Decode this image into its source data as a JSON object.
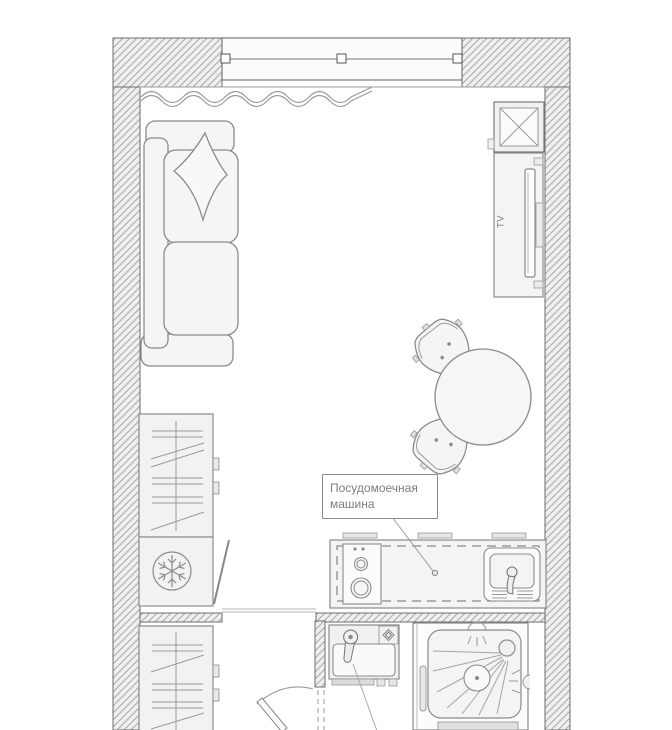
{
  "labels": {
    "tv": "TV",
    "dishwasher_line1": "Посудомоечная",
    "dishwasher_line2": "машина"
  },
  "colors": {
    "background": "#ffffff",
    "wall_fill": "#efefef",
    "wall_hatch": "#a8a8a8",
    "wall_edge": "#6e6e6e",
    "line": "#8b8b8b",
    "line_light": "#aaaaaa",
    "furniture_fill": "#f4f4f4",
    "text": "#7d7d7d"
  },
  "icons": {
    "freezer": "snowflake-icon",
    "ventilation": "x-cross-icon",
    "wardrobe": "hanger-rail-icon",
    "shower": "shower-spray-icon",
    "dishwasher_marker": "leader-dot-icon"
  }
}
